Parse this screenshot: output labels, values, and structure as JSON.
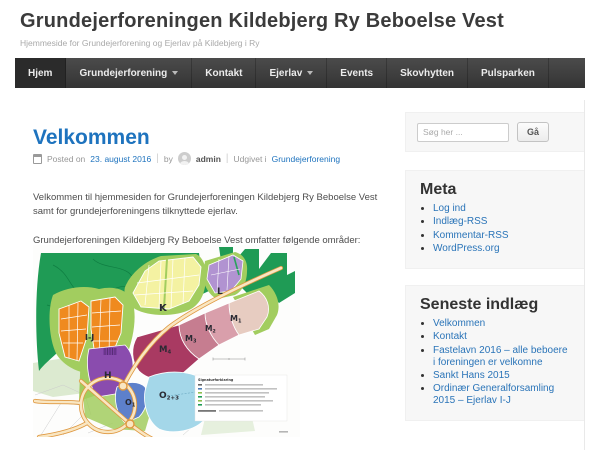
{
  "site": {
    "title": "Grundejerforeningen Kildebjerg Ry Beboelse Vest",
    "tagline": "Hjemmeside for Grundejerforening og Ejerlav på Kildebjerg i Ry"
  },
  "nav": {
    "items": [
      {
        "label": "Hjem",
        "active": true,
        "dropdown": false
      },
      {
        "label": "Grundejerforening",
        "active": false,
        "dropdown": true
      },
      {
        "label": "Kontakt",
        "active": false,
        "dropdown": false
      },
      {
        "label": "Ejerlav",
        "active": false,
        "dropdown": true
      },
      {
        "label": "Events",
        "active": false,
        "dropdown": false
      },
      {
        "label": "Skovhytten",
        "active": false,
        "dropdown": false
      },
      {
        "label": "Pulsparken",
        "active": false,
        "dropdown": false
      }
    ]
  },
  "post": {
    "title": "Velkommen",
    "meta": {
      "posted_label": "Posted on",
      "date": "23. august 2016",
      "sep": "|",
      "by_label": "by",
      "author": "admin",
      "published_label": "Udgivet i",
      "category": "Grundejerforening"
    },
    "paragraphs": [
      "Velkommen til hjemmesiden for Grundejerforeningen Kildebjerg Ry Beboelse Vest samt for grundejerforeningens tilknyttede ejerlav.",
      "Grundejerforeningen Kildebjerg Ry Beboelse Vest omfatter følgende områder:"
    ]
  },
  "map": {
    "legend_title": "Signaturforklaring",
    "areas": [
      {
        "main": "I-J",
        "sub": ""
      },
      {
        "main": "K",
        "sub": ""
      },
      {
        "main": "L",
        "sub": ""
      },
      {
        "main": "M",
        "sub": "1"
      },
      {
        "main": "M",
        "sub": "2"
      },
      {
        "main": "M",
        "sub": "3"
      },
      {
        "main": "M",
        "sub": "4"
      },
      {
        "main": "H",
        "sub": ""
      },
      {
        "main": "O",
        "sub": "1"
      },
      {
        "main": "O",
        "sub": "2+3"
      }
    ]
  },
  "sidebar": {
    "search": {
      "placeholder": "Søg her ...",
      "button_label": "Gå"
    },
    "meta_widget": {
      "title": "Meta",
      "links": [
        "Log ind",
        "Indlæg-RSS",
        "Kommentar-RSS",
        "WordPress.org"
      ]
    },
    "recent_widget": {
      "title": "Seneste indlæg",
      "links": [
        "Velkommen",
        "Kontakt",
        "Fastelavn 2016 – alle beboere i foreningen er velkomne",
        "Sankt Hans 2015",
        "Ordinær Generalforsamling 2015 – Ejerlav I-J"
      ]
    }
  },
  "colors": {
    "accent_blue": "#1e73be",
    "link_blue": "#2a74b8",
    "title_gray": "#3b3b3b",
    "nav_bg": "#3f3f3f",
    "nav_active_bg": "#2b2b2b",
    "widget_bg": "#f7f7f7",
    "map_forest_green": "#1f9b55",
    "map_light_green": "#a2cd5f",
    "map_orange": "#ef8a1f",
    "map_yellow": "#f4f2a2",
    "map_lavender": "#b193d1",
    "map_m1": "#e7ccc1",
    "map_m2": "#d99fab",
    "map_m3": "#c67d90",
    "map_m4": "#a93a62",
    "map_h_purple": "#8a4cae",
    "map_o1_blue": "#5d80cb",
    "map_o23_blue": "#a4d7e9",
    "map_road": "#f9e6c2",
    "map_road_edge": "#df9840"
  }
}
